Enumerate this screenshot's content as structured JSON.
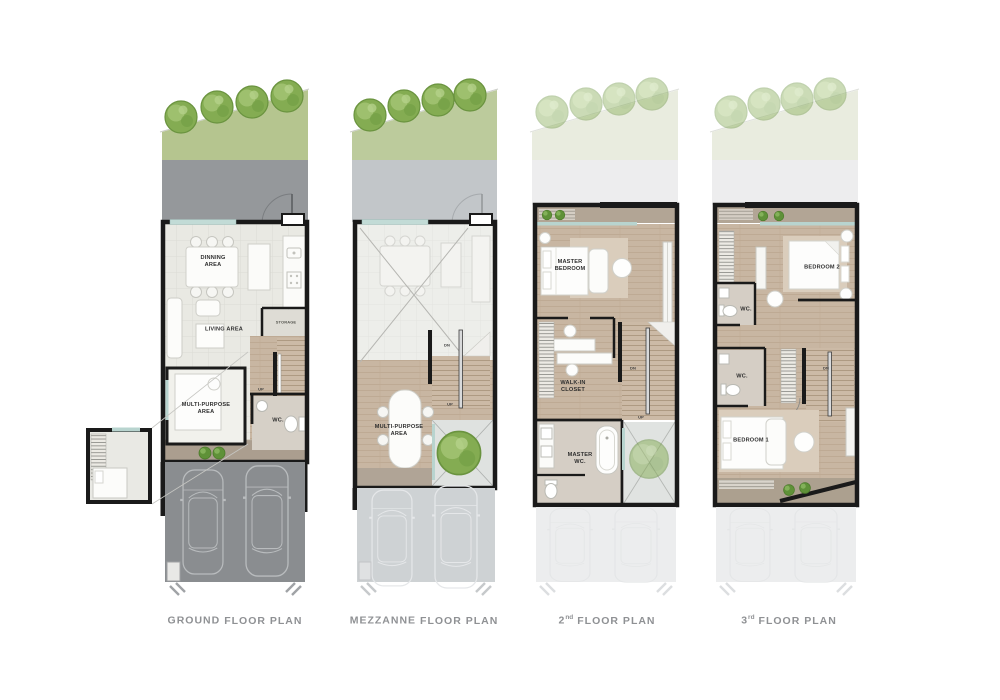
{
  "sheet": {
    "type": "townhouse-floor-plan-sheet",
    "background": "#ffffff"
  },
  "palette": {
    "tree_green": "#84ac52",
    "grass_green": "#b5c58f",
    "faded_grass": "#e9ecdf",
    "driveway_gray": "#95989b",
    "garage_gray": "#8a8d90",
    "wall_black": "#1a1a1a",
    "wood_floor": "#c8b6a2",
    "tile_floor": "#e9e9e3",
    "terrace_tan": "#ab9e8f",
    "glass_teal": "#b8d4cf",
    "title_gray": "#8f9194"
  },
  "plans": [
    {
      "id": "ground-floor",
      "title": {
        "prefix": "GROUND",
        "sup": "",
        "rest": "FLOOR PLAN"
      },
      "rooms": {
        "dinning": "DINNING\nAREA",
        "living": "LIVING AREA",
        "storage": "STORAGE",
        "multi_purpose": "MULTI-PURPOSE\nAREA",
        "wc": "WC.",
        "stair_up": "UP"
      }
    },
    {
      "id": "mezzanine-floor",
      "title": {
        "prefix": "MEZZANNE",
        "sup": "",
        "rest": "FLOOR PLAN"
      },
      "rooms": {
        "multi_purpose": "MULTI-PURPOSE\nAREA",
        "stair_dn": "DN",
        "stair_up": "UP"
      }
    },
    {
      "id": "second-floor",
      "title": {
        "prefix": "2",
        "sup": "nd",
        "rest": "FLOOR PLAN"
      },
      "rooms": {
        "master_bedroom": "MASTER\nBEDROOM",
        "walk_in_closet": "WALK-IN\nCLOSET",
        "master_wc": "MASTER\nWC.",
        "stair_dn": "DN",
        "stair_up": "UP"
      }
    },
    {
      "id": "third-floor",
      "title": {
        "prefix": "3",
        "sup": "rd",
        "rest": "FLOOR PLAN"
      },
      "rooms": {
        "bedroom2": "BEDROOM 2",
        "wc_upper": "WC.",
        "wc_lower": "WC.",
        "bedroom1": "BEDROOM 1",
        "stair_dn": "DN"
      }
    }
  ]
}
